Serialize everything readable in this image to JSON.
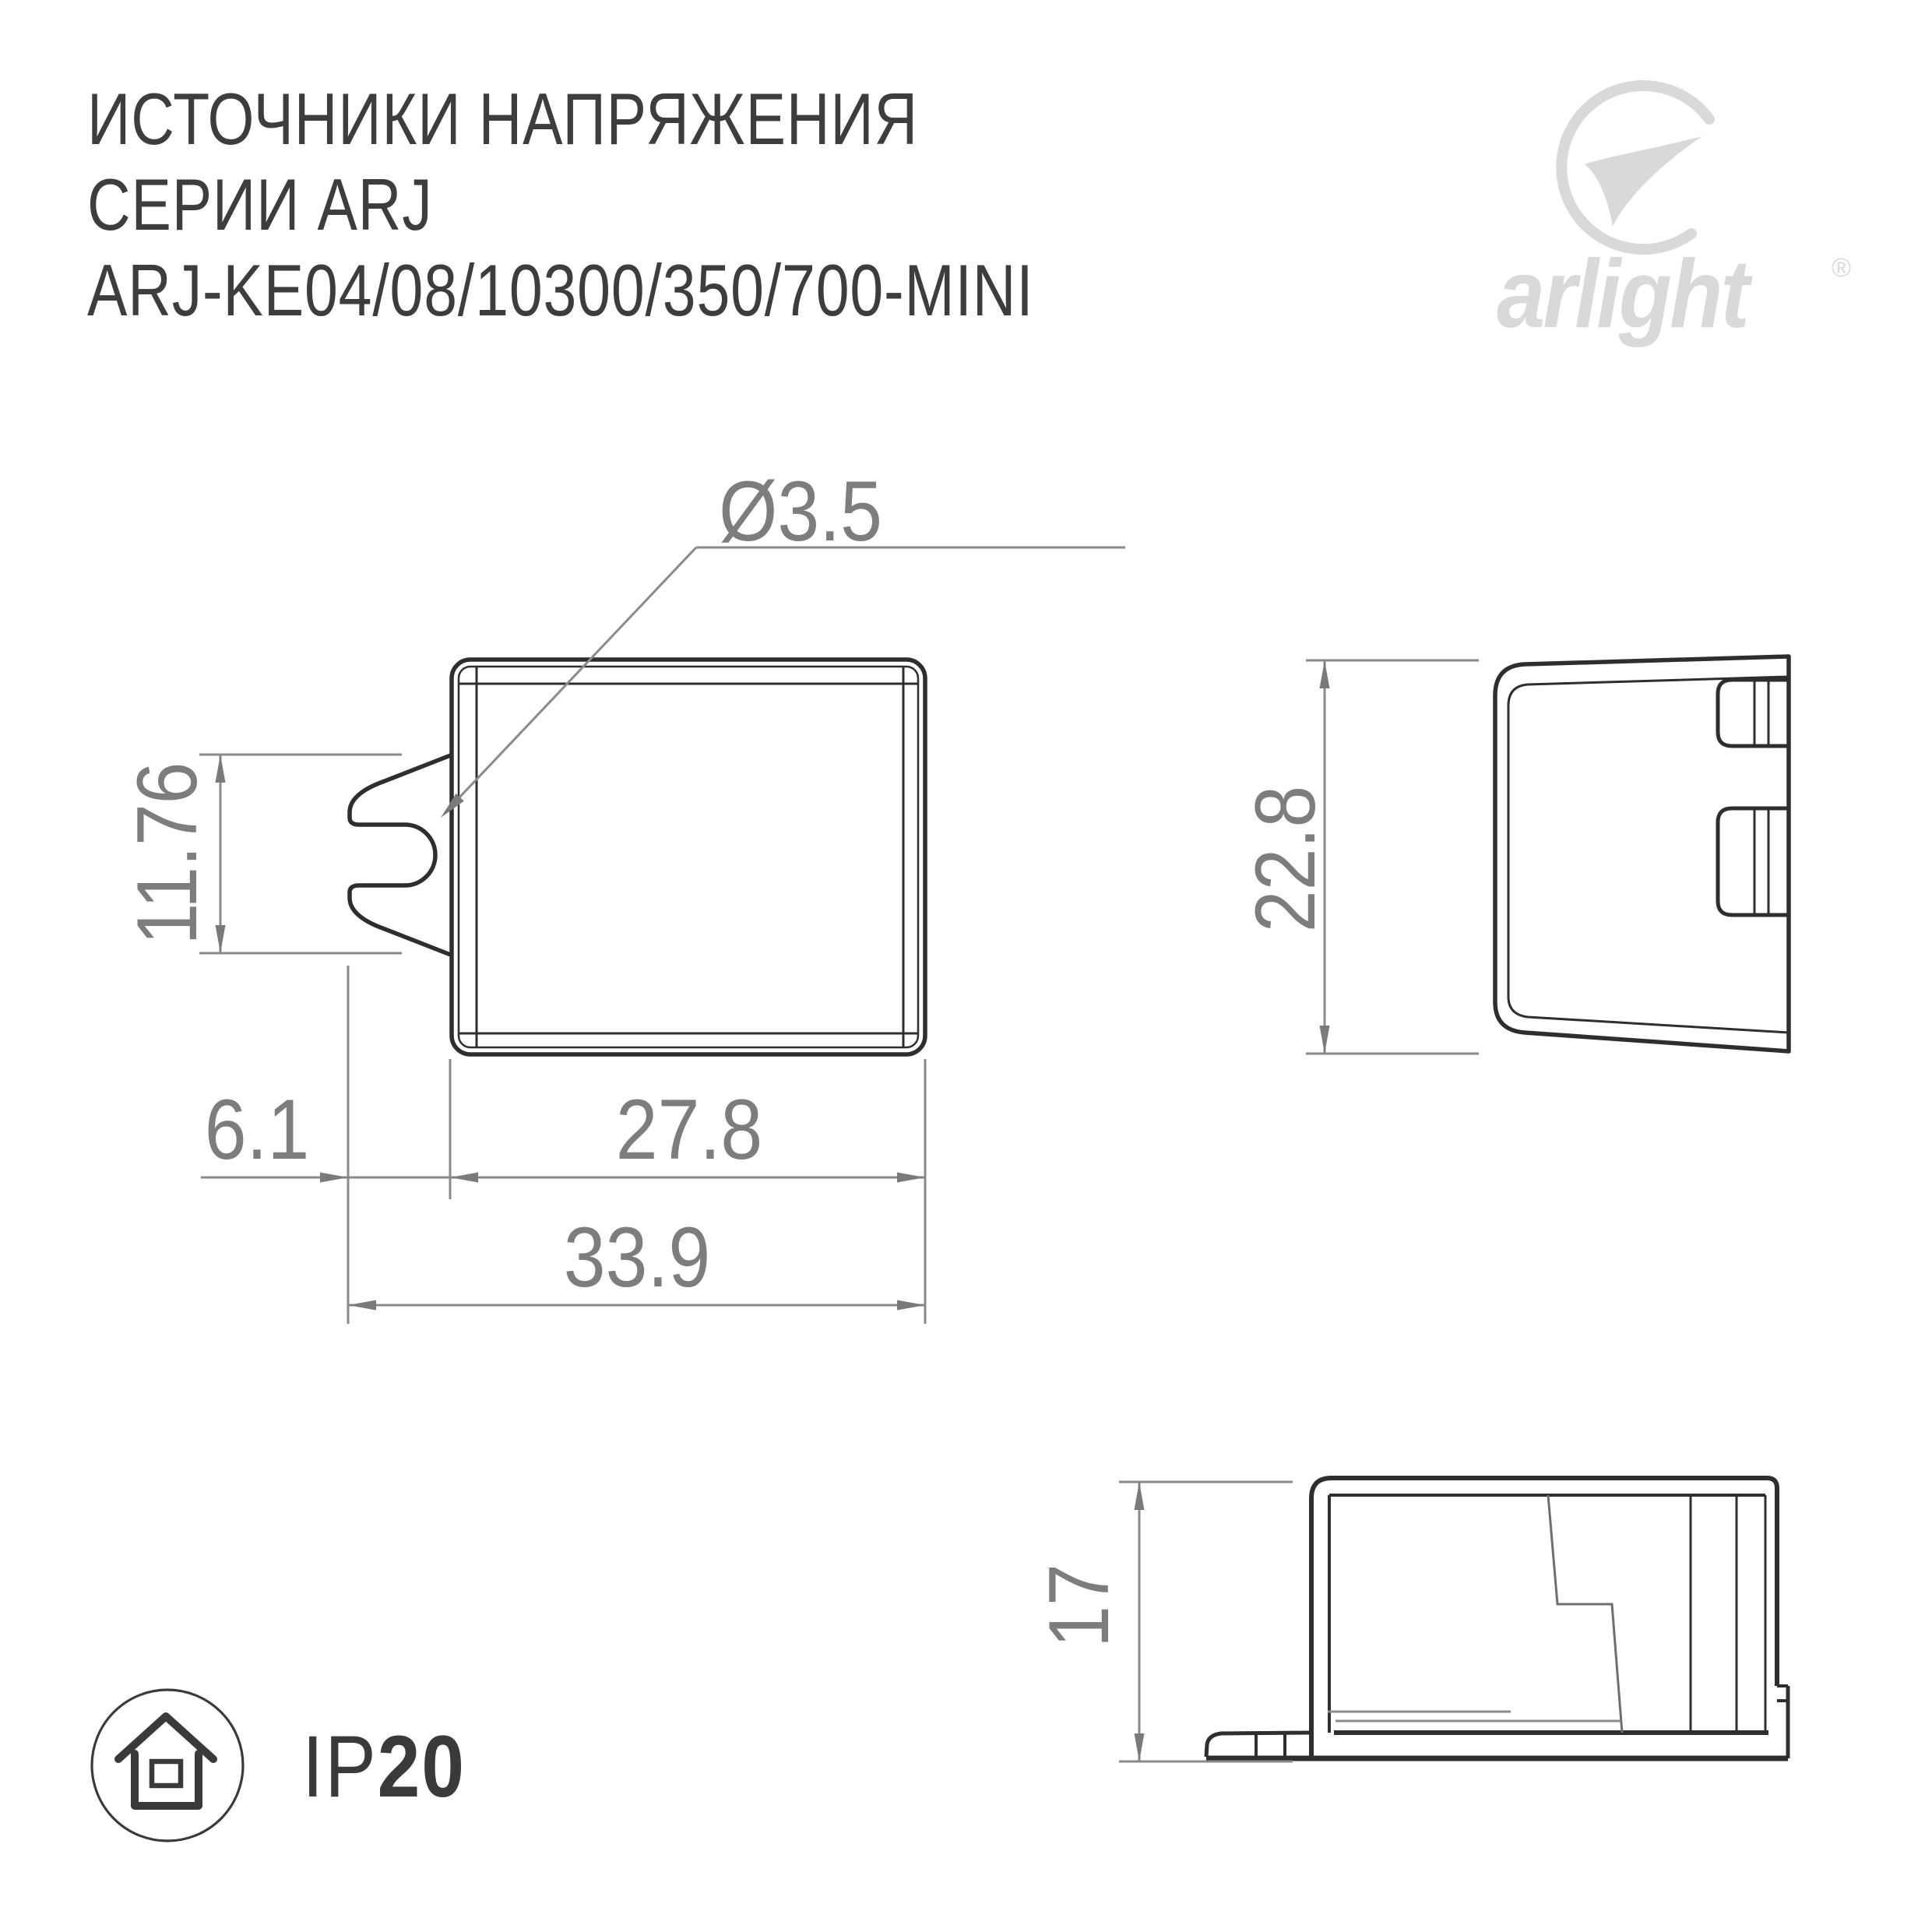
{
  "title": {
    "line1": "ИСТОЧНИКИ НАПРЯЖЕНИЯ",
    "line2": "СЕРИИ ARJ",
    "line3": "ARJ-KE04/08/10300/350/700-MINI"
  },
  "logo": {
    "brand": "arlight",
    "registered": "®"
  },
  "drawing": {
    "front_view": {
      "hole_diameter": "Ø3.5",
      "tab_height": "11.76",
      "tab_offset": "6.1",
      "body_width": "27.8",
      "total_width": "33.9"
    },
    "side_view": {
      "height": "22.8"
    },
    "profile_view": {
      "height": "17"
    }
  },
  "badge": {
    "prefix": "IP",
    "value": "20",
    "icon": "house-icon"
  },
  "colors": {
    "outline": "#2e2e2e",
    "dimension": "#8a8a8a",
    "dimension_text": "#7d7d7d",
    "title_text": "#3d3d3d",
    "logo": "#d9d9d9",
    "badge": "#3a3a3a"
  }
}
